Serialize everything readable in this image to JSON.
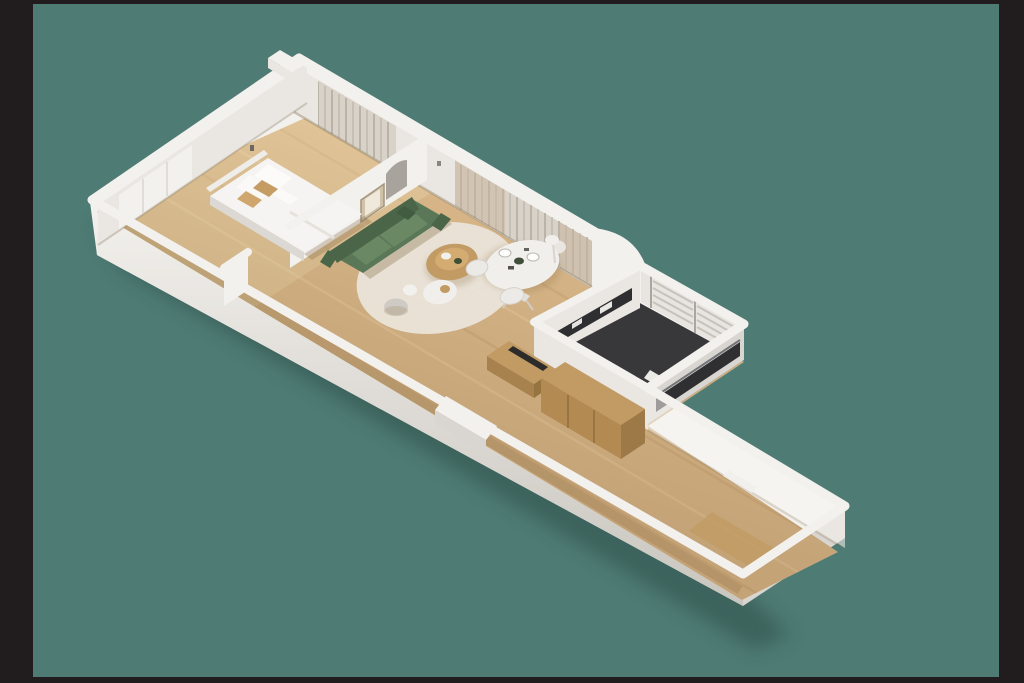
{
  "meta": {
    "description": "3D isometric render of a narrow one-bedroom apartment floor plan, viewed from above on a teal backdrop with black letterbox bars"
  },
  "colors": {
    "letterbox": "#211d1e",
    "backdrop": "#4e7b74",
    "model_shadow": "#2e4f48",
    "wall_top": "#f3f1ed",
    "wall_lit": "#eae7e3",
    "wall_shade": "#d9d5d0",
    "wall_outer_dark": "#c9c5bf",
    "floor_wood": "#dcba8c",
    "floor_streak_dark": "#c9a170",
    "floor_streak_light": "#eed3a7",
    "floor_shadow": "#7a5f38",
    "kitchen_floor": "#38383b",
    "kitchen_counter": "#2f2f31",
    "counter_steel": "#73757a",
    "curtain": "#d8d2c9",
    "curtain_fold": "#b2aba0",
    "curtain_beige": "#c9b69e",
    "glass": "#f7f6f3",
    "sofa": "#5a7757",
    "sofa_dark": "#4b6548",
    "sofa_light": "#6b8865",
    "throw_pillow": "#415c40",
    "bed_white": "#f5f4f2",
    "bed_shadow": "#dcd9d4",
    "cushion_tan": "#c59c63",
    "cushion_tan2": "#cfa76e",
    "wood_furniture": "#c29b64",
    "wood_furniture_dark": "#a8824e",
    "rug": "#eae4d9",
    "table_white": "#f1efec",
    "plate_green": "#3f4f38",
    "frame_beige": "#cfc2a8",
    "arch": "#a8a39c"
  },
  "scene": {
    "backdrop": "teal studio backdrop",
    "rooms": [
      {
        "name": "bedroom",
        "objects": [
          "double-bed",
          "white-pillows",
          "tan-cushions",
          "built-in-wardrobe",
          "wall-switch"
        ]
      },
      {
        "name": "living-dining-area",
        "objects": [
          "green-sofa",
          "round-rug",
          "wood-coffee-table",
          "side-table",
          "pouf",
          "oval-dining-table",
          "dining-chairs",
          "place-settings",
          "floor-lamp",
          "picture-frame",
          "arched-niche",
          "full-height-curtains"
        ]
      },
      {
        "name": "kitchen",
        "objects": [
          "dark-floor",
          "dark-counters",
          "open-shelving",
          "white-appliance",
          "wood-cabinet",
          "wood-wardrobe"
        ]
      },
      {
        "name": "hallway",
        "objects": [
          "frosted-glass-partition",
          "door-leaf",
          "floor-mat",
          "entrance-nook"
        ]
      }
    ]
  }
}
